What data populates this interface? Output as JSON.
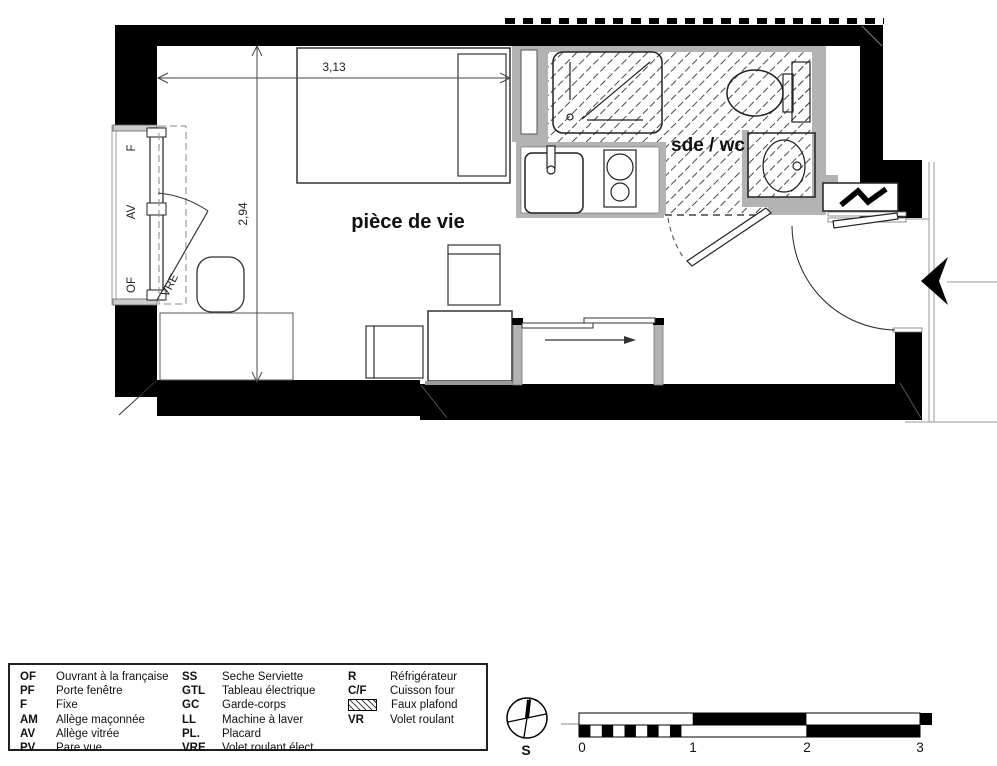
{
  "plan": {
    "rooms": {
      "living": "pièce de vie",
      "bath": "sde / wc"
    },
    "dimensions": {
      "width": "3,13",
      "height": "2,94"
    },
    "window": {
      "top": "F",
      "middle": "AV",
      "bottom": "OF",
      "shutter": "VRE"
    }
  },
  "legend": {
    "col1": [
      {
        "abbr": "OF",
        "label": "Ouvrant à la française"
      },
      {
        "abbr": "PF",
        "label": "Porte fenêtre"
      },
      {
        "abbr": "F",
        "label": "Fixe"
      },
      {
        "abbr": "AM",
        "label": "Allège maçonnée"
      },
      {
        "abbr": "AV",
        "label": "Allège vitrée"
      },
      {
        "abbr": "PV",
        "label": "Pare vue"
      }
    ],
    "col2": [
      {
        "abbr": "SS",
        "label": "Seche Serviette"
      },
      {
        "abbr": "GTL",
        "label": "Tableau électrique"
      },
      {
        "abbr": "GC",
        "label": "Garde-corps"
      },
      {
        "abbr": "LL",
        "label": "Machine à laver"
      },
      {
        "abbr": "PL.",
        "label": "Placard"
      },
      {
        "abbr": "VRE",
        "label": "Volet roulant élect."
      }
    ],
    "col3": [
      {
        "abbr": "R",
        "label": "Réfrigérateur"
      },
      {
        "abbr": "C/F",
        "label": "Cuisson four"
      },
      {
        "abbr": "",
        "label": "Faux plafond"
      },
      {
        "abbr": "VR",
        "label": "Volet roulant"
      }
    ]
  },
  "scale_bar": {
    "south": "S",
    "ticks": [
      "0",
      "1",
      "2",
      "3"
    ]
  },
  "colors": {
    "wall": "#000000",
    "lining": "#b3b3b3",
    "hatch_line": "#4a4a4a"
  }
}
